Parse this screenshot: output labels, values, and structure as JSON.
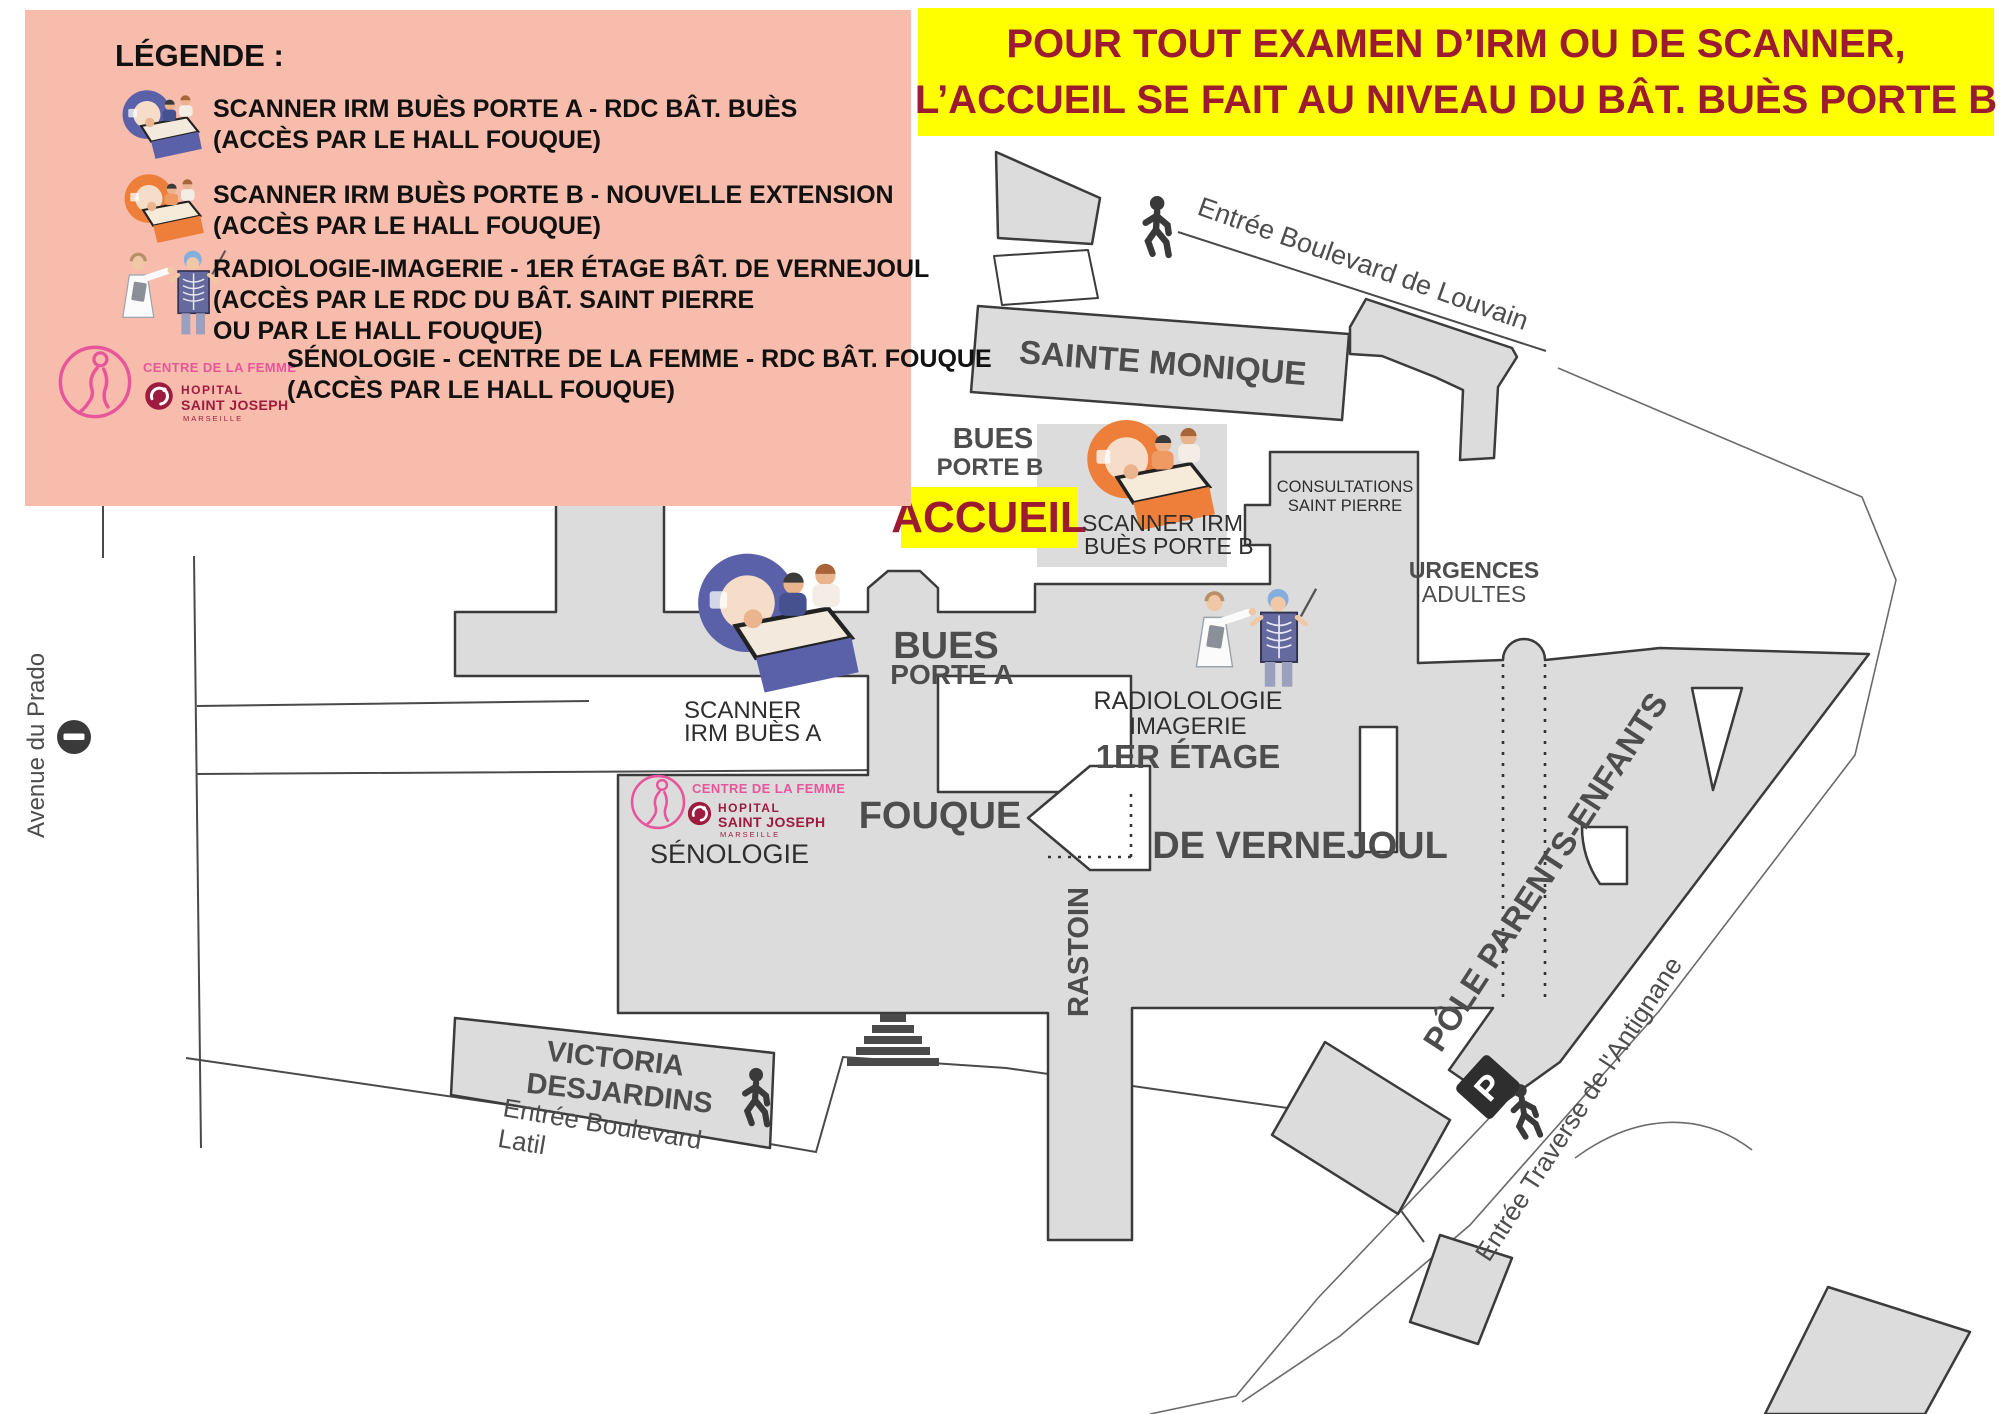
{
  "colors": {
    "building_fill": "#dcdcdc",
    "building_stroke": "#3b3b3b",
    "legend_bg": "#f8bcac",
    "banner_bg": "#ffff00",
    "banner_text": "#9c1b31",
    "accueil_bg": "#ffff00",
    "accueil_text": "#9c1b31",
    "scanner_a_blue": "#5a61a8",
    "scanner_b_orange": "#ee7f3b",
    "centre_femme_pink": "#e7569b",
    "hopital_red": "#9d1b3f",
    "label_gray": "#4d4d4d",
    "icon_dark": "#3a3a3a"
  },
  "legend": {
    "title": "LÉGENDE :",
    "item1_line1": "SCANNER IRM BUÈS PORTE A - RDC BÂT. BUÈS",
    "item1_line2": "(ACCÈS PAR LE HALL FOUQUE)",
    "item2_line1": "SCANNER IRM BUÈS PORTE B - NOUVELLE EXTENSION",
    "item2_line2": "(ACCÈS PAR LE HALL FOUQUE)",
    "item3_line1": "RADIOLOGIE-IMAGERIE - 1ER ÉTAGE BÂT. DE VERNEJOUL",
    "item3_line2": "(ACCÈS PAR LE RDC DU BÂT. SAINT PIERRE",
    "item3_line3": "OU PAR LE HALL FOUQUE)",
    "item4_line1": "SÉNOLOGIE - CENTRE DE LA FEMME - RDC BÂT. FOUQUE",
    "item4_line2": "(ACCÈS PAR LE HALL FOUQUE)"
  },
  "banner": {
    "line1": "POUR TOUT EXAMEN D’IRM OU DE SCANNER,",
    "line2": "L’ACCUEIL SE FAIT AU NIVEAU DU BÂT. BUÈS PORTE B"
  },
  "accueil": "ACCUEIL",
  "map": {
    "streets": {
      "prado": "Avenue du Prado",
      "louvain": "Entrée Boulevard de Louvain",
      "latil_line1": "Entrée Boulevard",
      "latil_line2": "Latil",
      "antignane": "Entrée Traverse de l'Antignane"
    },
    "buildings": {
      "sainte_monique": "SAINTE MONIQUE",
      "bues_b_line1": "BUES",
      "bues_b_line2": "PORTE B",
      "scanner_b_line1": "SCANNER IRM",
      "scanner_b_line2": "BUÈS PORTE B",
      "consultations_line1": "CONSULTATIONS",
      "consultations_line2": "SAINT PIERRE",
      "urgences_line1": "URGENCES",
      "urgences_line2": "ADULTES",
      "bues_a_line1": "BUES",
      "bues_a_line2": "PORTE A",
      "scanner_a_line1": "SCANNER",
      "scanner_a_line2": "IRM BUÈS A",
      "radiologie_line1": "RADIOLOLOGIE",
      "radiologie_line2": "IMAGERIE",
      "radiologie_line3": "1ER ÉTAGE",
      "fouque": "FOUQUE",
      "senologie": "SÉNOLOGIE",
      "de_vernejoul": "DE VERNEJOUL",
      "rastoin": "RASTOIN",
      "victoria_line1": "VICTORIA",
      "victoria_line2": "DESJARDINS",
      "pole": "PÔLE PARENTS-ENFANTS"
    },
    "logos": {
      "centre_femme": "CENTRE DE LA FEMME",
      "hopital": "HOPITAL",
      "saint_joseph": "SAINT JOSEPH",
      "marseille": "MARSEILLE",
      "parking_letter": "P"
    }
  }
}
